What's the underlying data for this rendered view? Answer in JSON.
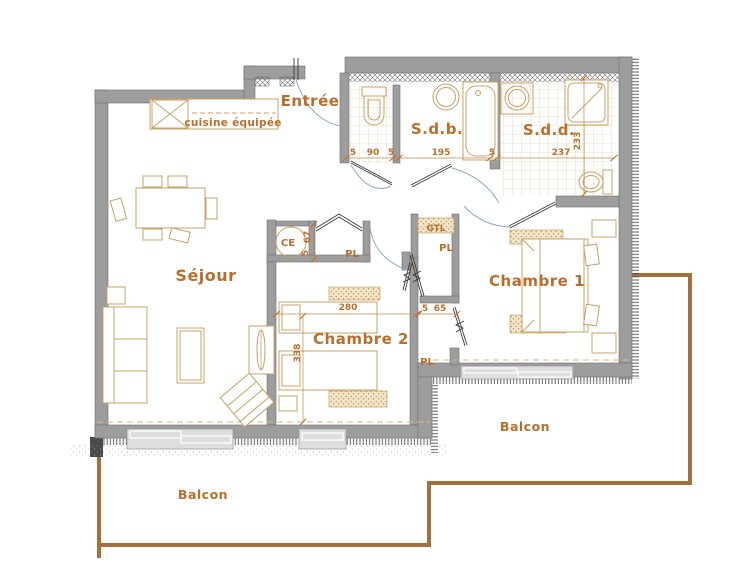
{
  "colors": {
    "label_orange": "#b96f2b",
    "wall_gray": "#9d9d9d",
    "furniture_tan": "#c9a066",
    "balcony_brown": "#a4703e",
    "door_arc_blue": "#8fa8c8"
  },
  "rooms": {
    "entree": {
      "label": "Entrée"
    },
    "sejour": {
      "label": "Séjour"
    },
    "sdb": {
      "label": "S.d.b."
    },
    "sdd": {
      "label": "S.d.d."
    },
    "chambre1": {
      "label": "Chambre 1"
    },
    "chambre2": {
      "label": "Chambre 2"
    },
    "balcon_left": {
      "label": "Balcon"
    },
    "balcon_right": {
      "label": "Balcon"
    }
  },
  "annotations": {
    "kitchen": "cuisine équipée",
    "water_heater": "CE",
    "gtl": "GTL",
    "closet_entree": "PL",
    "closet_hall": "PL",
    "closet_chambre1": "PL"
  },
  "dimensions": {
    "wc": {
      "left": "5",
      "width": "90",
      "right": "5"
    },
    "sdb": {
      "width": "195",
      "right": "5"
    },
    "sdd": {
      "width": "237",
      "height": "233"
    },
    "ce": {
      "a": "5",
      "b": "67"
    },
    "chambre2": {
      "width": "280",
      "height": "338"
    },
    "closet_hall": {
      "left": "5",
      "width": "65"
    }
  }
}
